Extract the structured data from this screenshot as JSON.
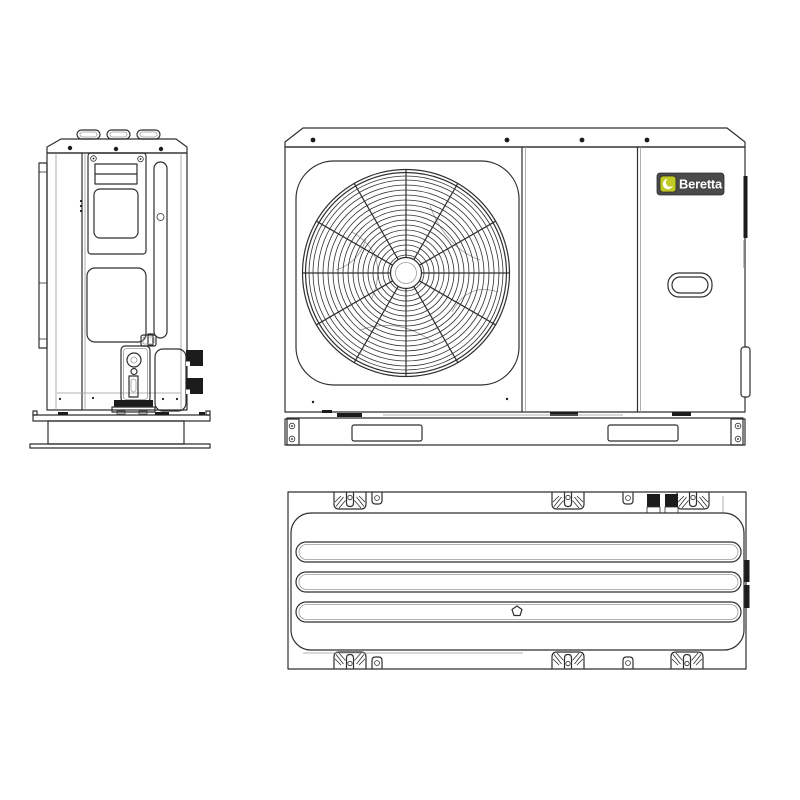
{
  "page": {
    "background": "#ffffff"
  },
  "colors": {
    "page_bg": "#ffffff",
    "line": "#2f2f2f",
    "line_light": "#9a9a9a",
    "fill_dark": "#1c1c1c",
    "badge_bg": "#4a4a4a",
    "badge_icon": "#c1ca22",
    "badge_text": "#ffffff"
  },
  "brand": {
    "name": "Beretta"
  },
  "icons": {
    "brand_leaf": "leaf-crescent-in-square"
  }
}
